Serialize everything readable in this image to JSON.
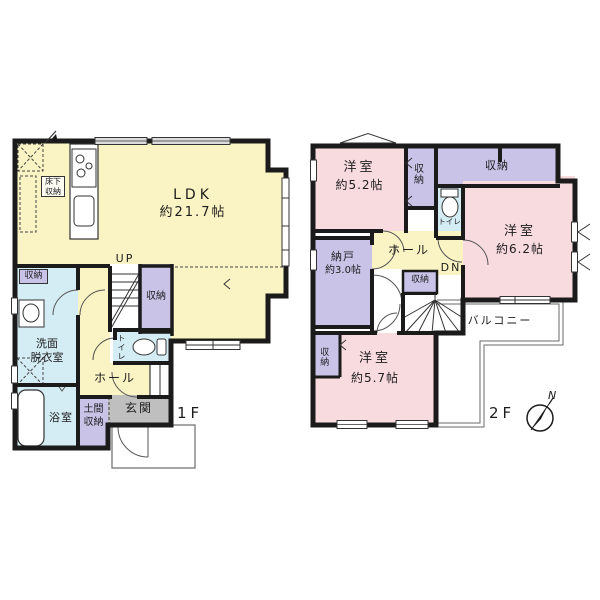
{
  "floor1": {
    "label": "1F",
    "ldk": {
      "name": "LDK",
      "size": "約21.7帖"
    },
    "underfloor_storage": {
      "line1": "床下",
      "line2": "収納"
    },
    "stairs_up": "UP",
    "stair_closet": "収納",
    "washroom_closet": "収納",
    "washroom": {
      "line1": "洗面",
      "line2": "脱衣室"
    },
    "toilet": "トイレ",
    "hall": "ホール",
    "bathroom": "浴室",
    "doma_storage": {
      "line1": "土間",
      "line2": "収納"
    },
    "entrance": "玄関"
  },
  "floor2": {
    "label": "2F",
    "bedroom_a": {
      "name": "洋室",
      "size": "約5.2帖"
    },
    "closet_a": "収納",
    "closet_b": "収納",
    "toilet": "トイレ",
    "bedroom_b": {
      "name": "洋室",
      "size": "約6.2帖"
    },
    "hall": "ホール",
    "storage_room": {
      "name": "納戸",
      "size": "約3.0帖"
    },
    "hall_closet": "収納",
    "stairs_down": "DN",
    "bedroom_c_closet": "収納",
    "bedroom_c": {
      "name": "洋室",
      "size": "約5.7帖"
    },
    "balcony": "バルコニー"
  },
  "compass": {
    "north": "N"
  },
  "colors": {
    "wall": "#1b1b1b",
    "ldk_yellow": "#faf3c3",
    "bedroom_pink": "#f8dbdf",
    "storage_purple": "#c9c3e8",
    "wet_blue": "#d4ecf3",
    "entrance_gray": "#bfbfbf"
  }
}
